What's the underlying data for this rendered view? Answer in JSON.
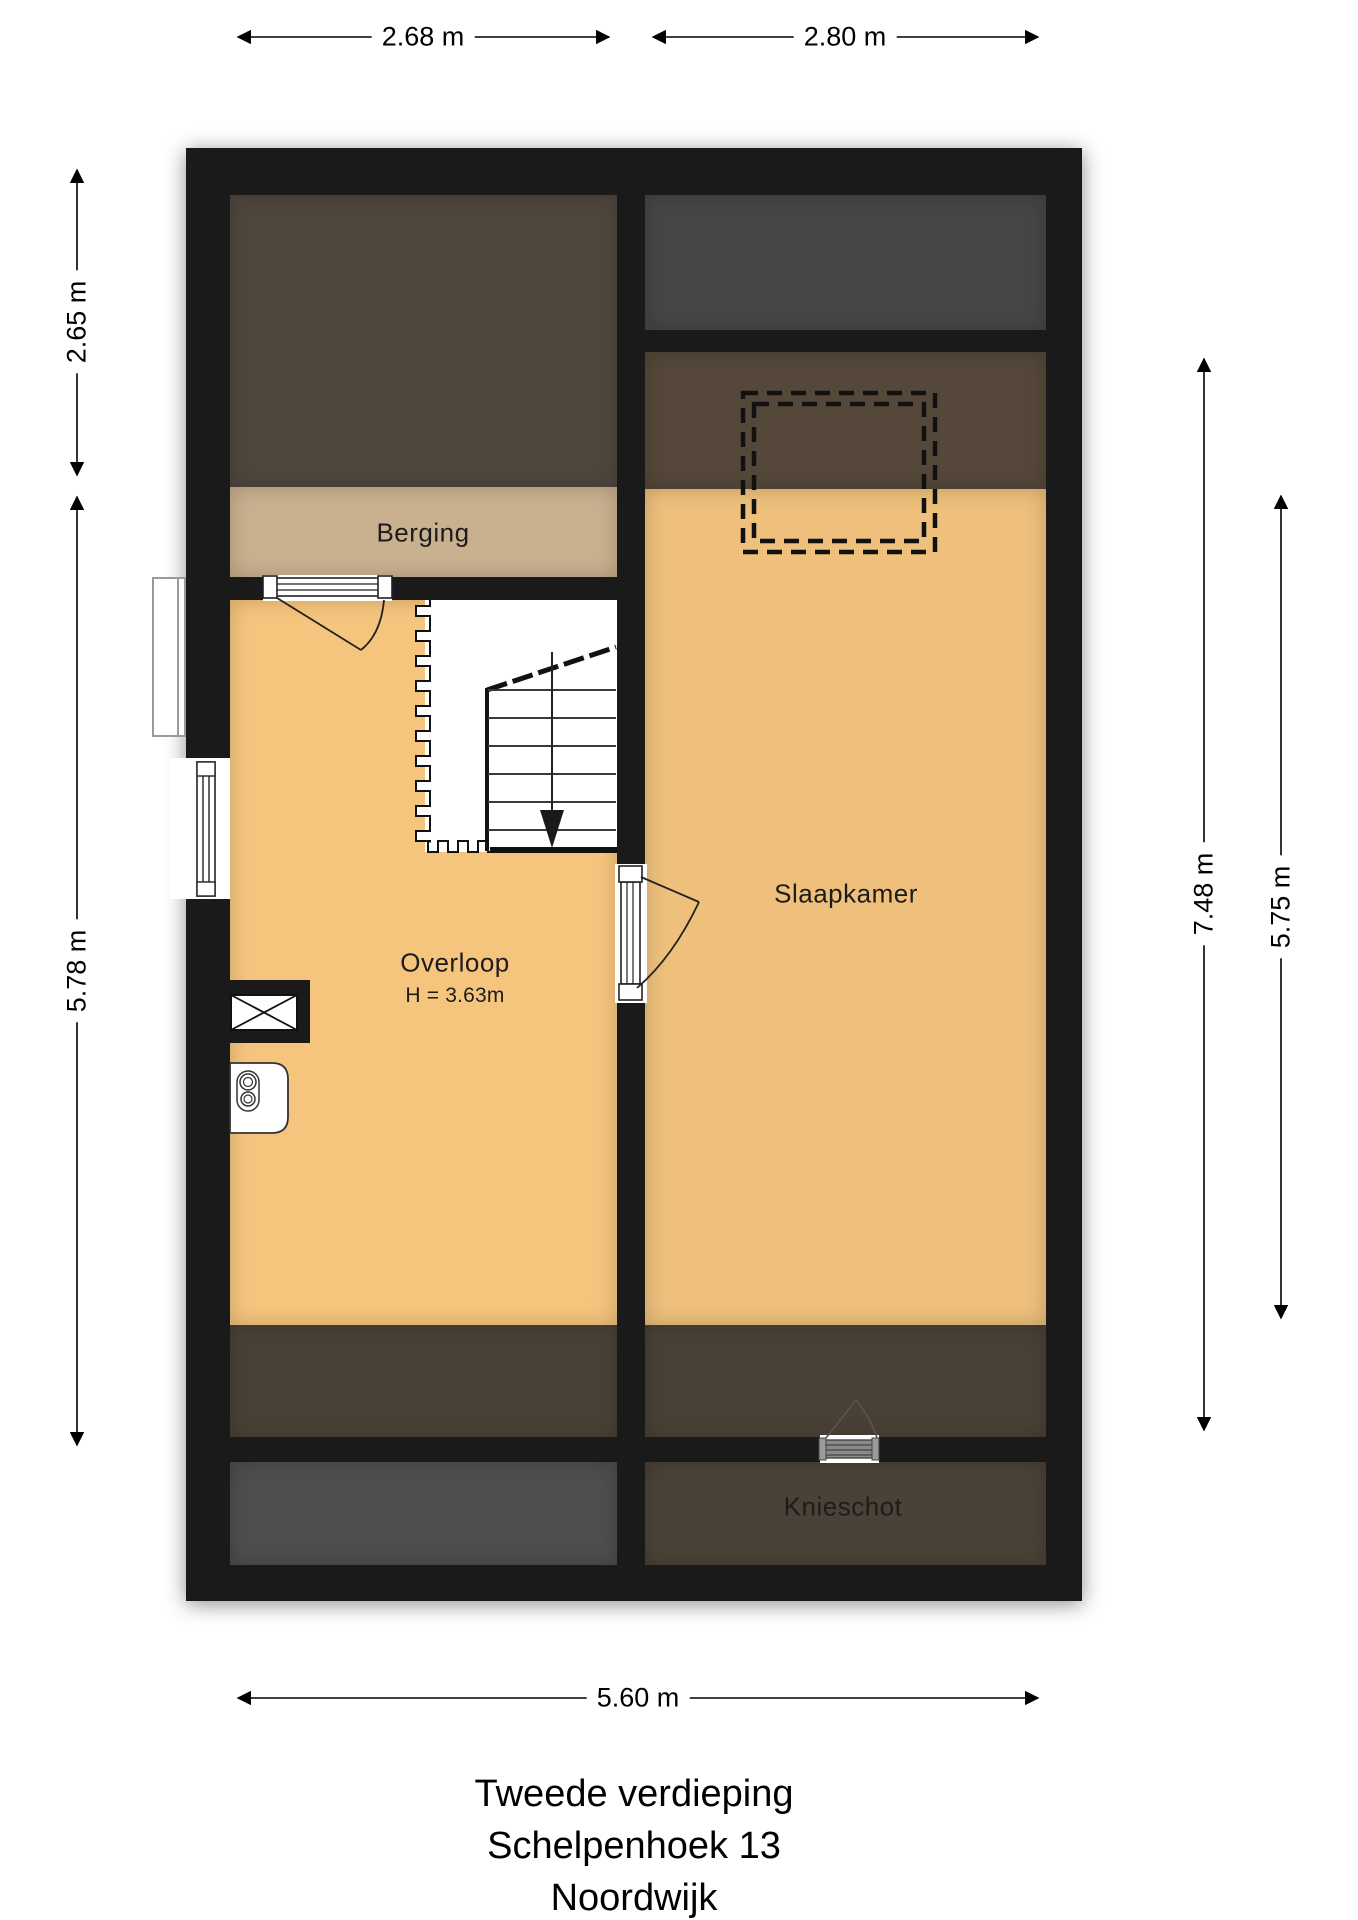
{
  "title": {
    "line1": "Tweede verdieping",
    "line2": "Schelpenhoek 13",
    "line3": "Noordwijk"
  },
  "rooms": {
    "berging": "Berging",
    "overloop": "Overloop",
    "overloop_height": "H = 3.63m",
    "slaapkamer": "Slaapkamer",
    "knieschot": "Knieschot"
  },
  "dimensions": {
    "top_left": "2.68 m",
    "top_right": "2.80 m",
    "left_upper": "2.65 m",
    "left_lower": "5.78 m",
    "right_full": "7.48 m",
    "right_inner": "5.75 m",
    "bottom": "5.60 m"
  },
  "colors": {
    "wall": "#1a1a1a",
    "floor_orange": "#f6c57d",
    "floor_orange_dark": "#eec07c",
    "berging_tan": "#c9b190",
    "roof_void_brown": "#4f473e",
    "roof_void_gray": "#464646",
    "slope_overlay": "#55483a",
    "slope_overlay_dark": "#4a4136",
    "bottom_room_gray": "#4e4e4e",
    "knieschot_brown": "#4b4237"
  }
}
